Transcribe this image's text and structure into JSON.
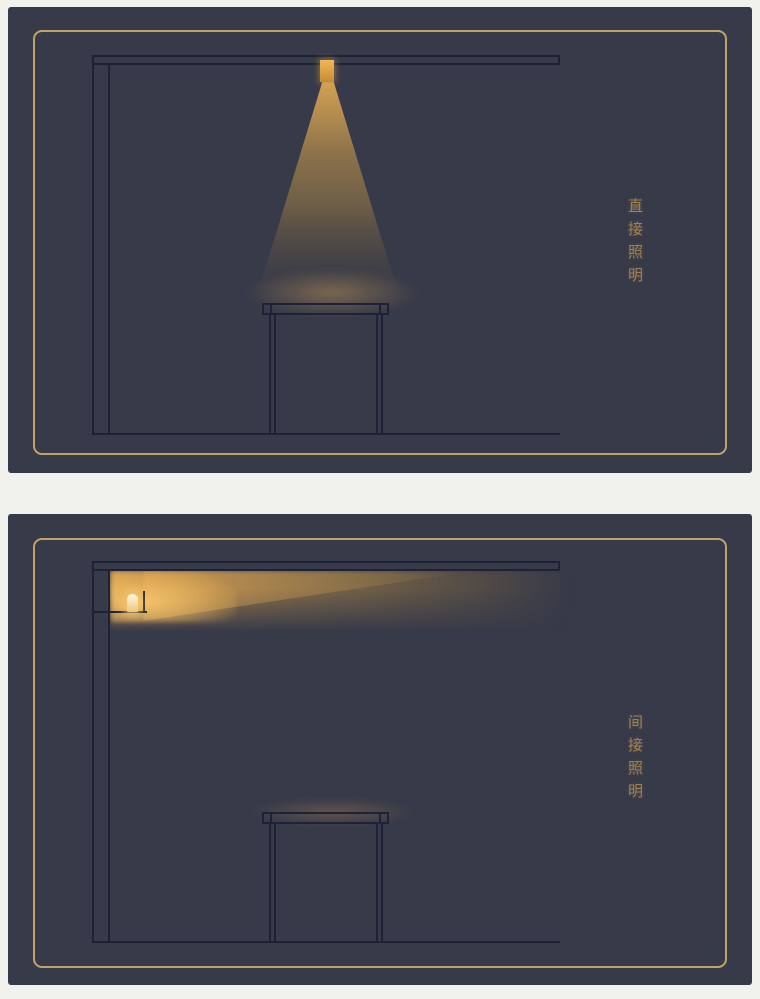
{
  "colors": {
    "page-bg": "#f1f1ee",
    "panel-bg": "#373a49",
    "line": "#1f2236",
    "frame-gold": "#c3a267",
    "caption-gold": "#a1824e",
    "lamp-warm": "#efc678",
    "cone-warm": "#c89a50"
  },
  "panels": [
    {
      "caption": "直接照明"
    },
    {
      "caption": "间接照明"
    }
  ]
}
